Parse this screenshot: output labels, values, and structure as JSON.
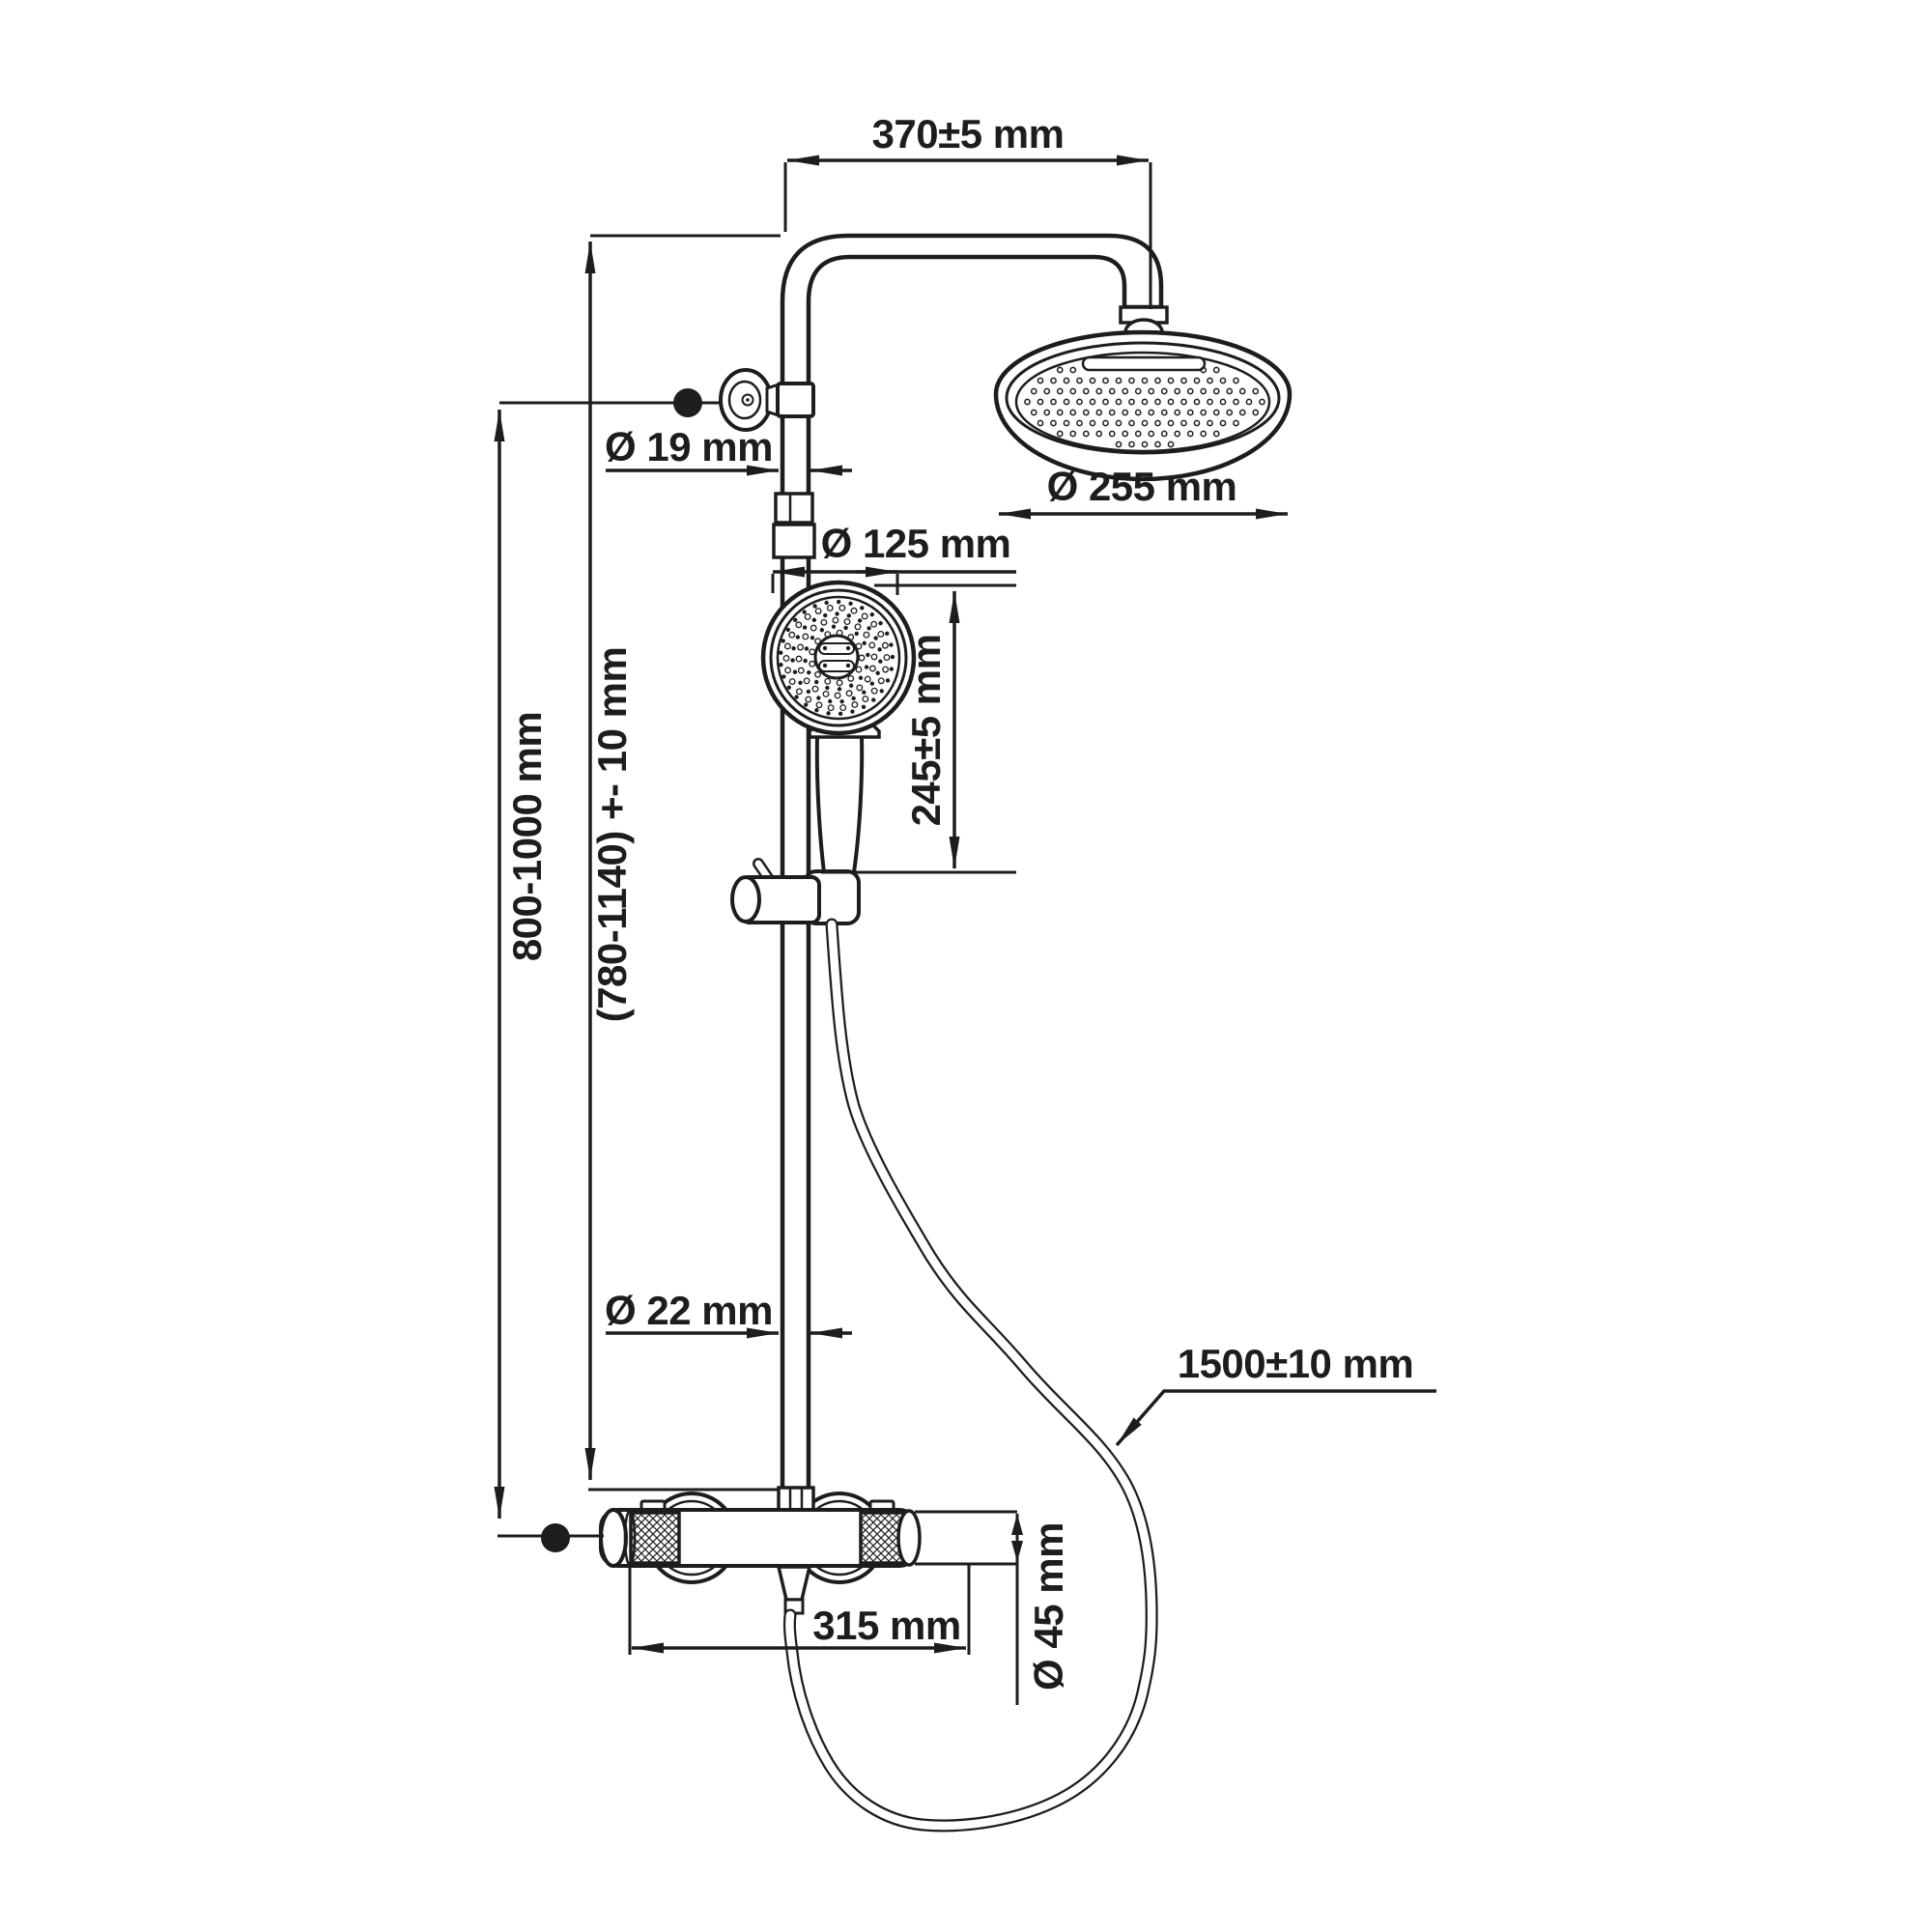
{
  "drawing": {
    "type": "shower-system-technical-drawing",
    "units": "mm"
  },
  "colors": {
    "ink": "#1d1d1b",
    "background": "#ffffff"
  },
  "labels": {
    "arm_reach": "370±5 mm",
    "rain_head_diameter": "Ø 255 mm",
    "riser_top_diameter": "Ø 19 mm",
    "hand_shower_diameter": "Ø 125 mm",
    "hand_shower_length": "245±5 mm",
    "wall_outlet_to_mixer": "800-1000 mm",
    "riser_pipe_range": "(780-1140) +- 10 mm",
    "riser_bottom_diameter": "Ø 22 mm",
    "hose_length": "1500±10 mm",
    "mixer_width": "315 mm",
    "mixer_body_diameter": "Ø 45 mm"
  }
}
